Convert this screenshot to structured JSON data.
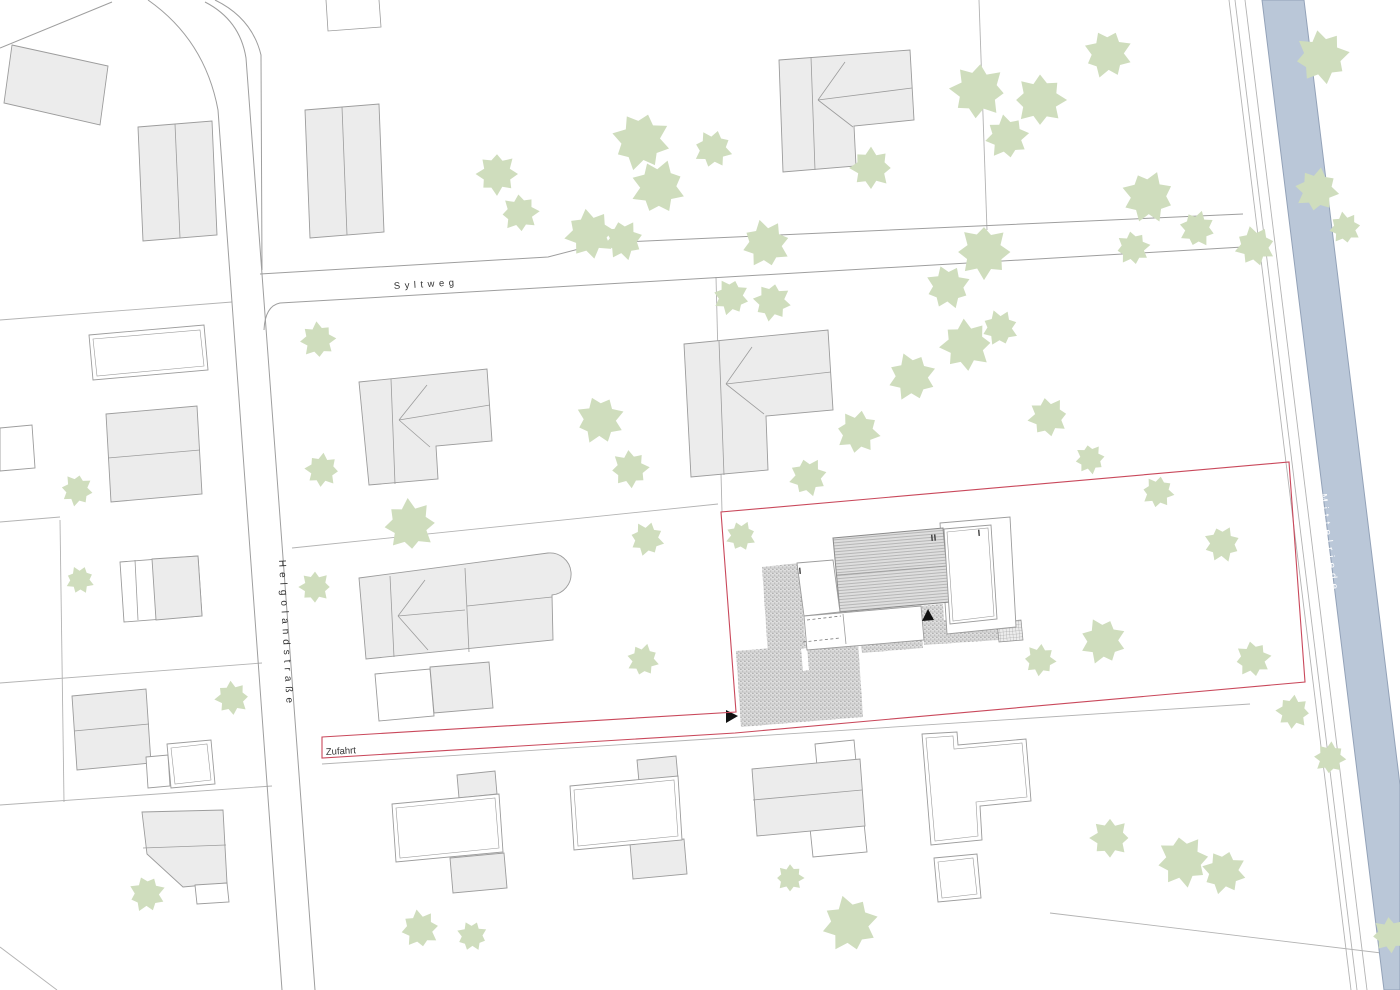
{
  "labels": {
    "street_top": "Syltweg",
    "street_left": "Helgolandstraße",
    "access_road": "Zufahrt",
    "waterway": "Mittelriede",
    "storey_main": "II",
    "storey_east_wing": "I",
    "storey_west_wing": "I"
  },
  "colors": {
    "parcel_line": "#b3b3b3",
    "street_line": "#9e9e9e",
    "building_fill": "#ececec",
    "building_outline": "#9c9c9c",
    "tree_fill": "#cfddbd",
    "water_fill": "#bac7d8",
    "water_edge": "#93a2b8",
    "boundary_red": "#c9485b",
    "roof_hatch_fill": "#dedede",
    "roof_hatch_line": "#9c9c9c",
    "paving_fill": "#e0e0e0",
    "paving_dot": "#8f8f8f",
    "label_text": "#333333",
    "water_text": "#ffffff",
    "marker": "#111111"
  }
}
